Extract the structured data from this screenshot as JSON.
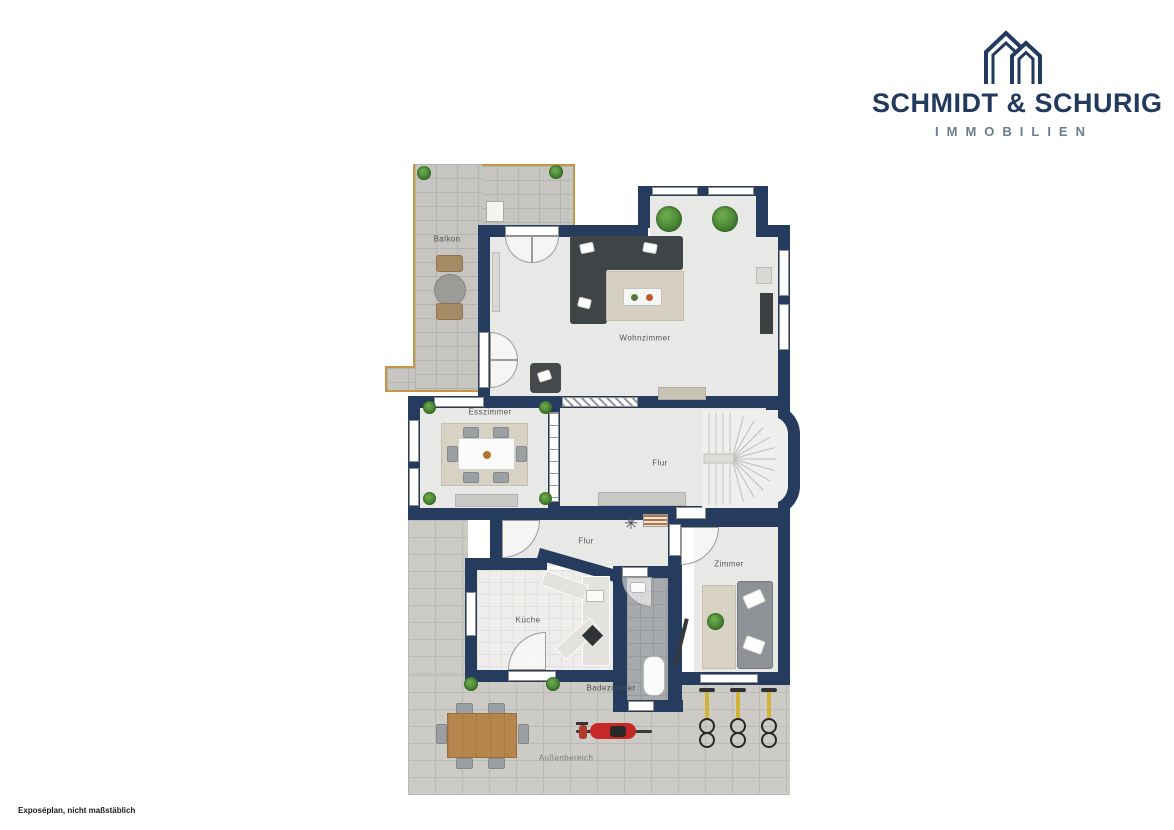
{
  "brand": {
    "name": "SCHMIDT & SCHURIG",
    "subtitle": "IMMOBILIEN"
  },
  "colors": {
    "wall": "#263c5f",
    "brand": "#223a5e",
    "brand_sub": "#6b7c8e",
    "balcony_border": "#c8963f",
    "floor": "#e8e8e6",
    "paver": "#cccbc6",
    "bath_tile": "#a6aaad"
  },
  "rooms": {
    "balkon": "Balkon",
    "wohnzimmer": "Wohnzimmer",
    "esszimmer": "Esszimmer",
    "flur_og": "Flur",
    "flur_eg": "Flur",
    "zimmer": "Zimmer",
    "kueche": "Küche",
    "badezimmer": "Badezimmer",
    "aussenbereich": "Außenbereich"
  },
  "footer": {
    "disclaimer": "Exposéplan, nicht maßstäblich"
  }
}
